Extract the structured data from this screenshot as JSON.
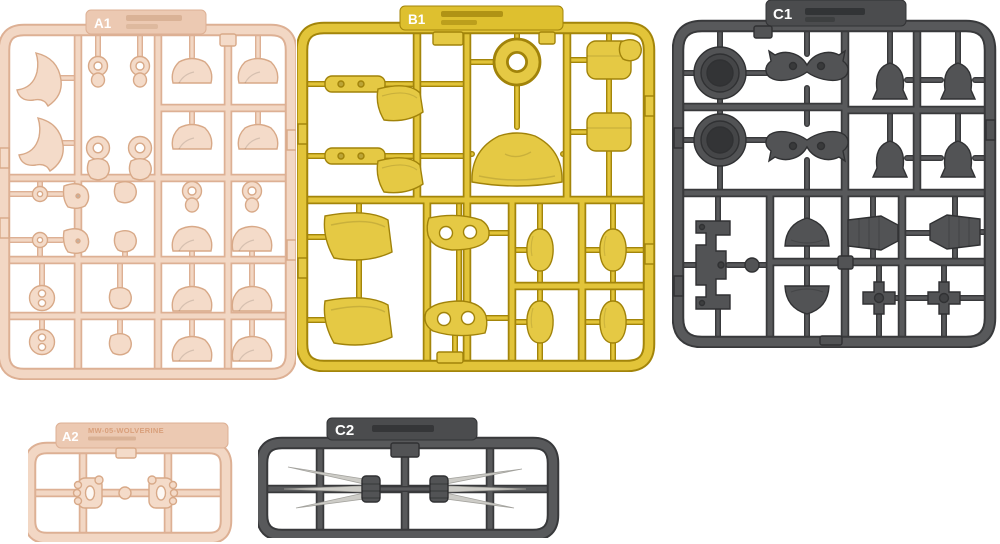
{
  "image": {
    "background": "#ffffff",
    "subject": "plastic model kit runner sprues"
  },
  "colors": {
    "beige_plastic": "#f2d7c4",
    "beige_edge": "#ddb094",
    "yellow_plastic": "#e2c439",
    "yellow_edge": "#a3850a",
    "gray_plastic": "#58595b",
    "gray_edge": "#38393b",
    "silver_blades": "#cdccc7",
    "tab_label_text": "#ffffff"
  },
  "sprues": {
    "a1": {
      "code": "A1",
      "color": "beige"
    },
    "b1": {
      "code": "B1",
      "color": "yellow"
    },
    "c1": {
      "code": "C1",
      "color": "dark-gray"
    },
    "a2": {
      "code": "A2",
      "color": "beige",
      "note": "MW-05-WOLVERINE"
    },
    "c2": {
      "code": "C2",
      "color": "dark-gray"
    }
  }
}
